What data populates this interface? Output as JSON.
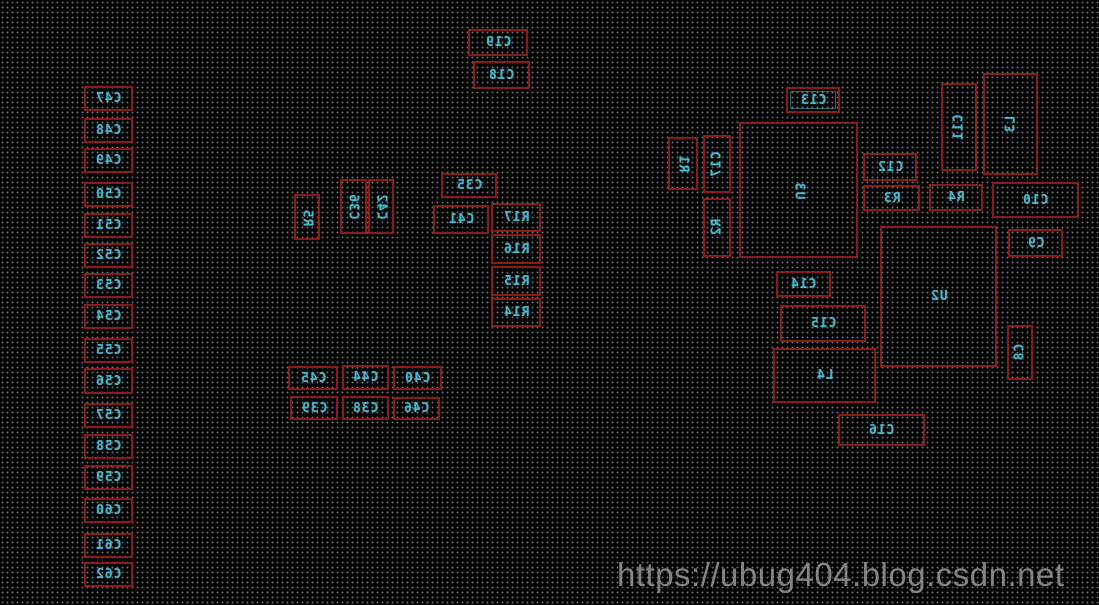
{
  "board": {
    "view": "pcb-bottom-layer-mirrored",
    "colors": {
      "background": "#000000",
      "grid_dots": "#cddce1",
      "component_outline": "#8a1b1b",
      "designator_text": "#46b8cc",
      "watermark_text": "#8f8f8f"
    },
    "components": [
      {
        "id": "C47",
        "label": "C47",
        "x": 84,
        "y": 86,
        "w": 49,
        "h": 25,
        "orient": "h"
      },
      {
        "id": "C48",
        "label": "C48",
        "x": 84,
        "y": 118,
        "w": 49,
        "h": 25,
        "orient": "h"
      },
      {
        "id": "C49",
        "label": "C49",
        "x": 84,
        "y": 148,
        "w": 49,
        "h": 25,
        "orient": "h"
      },
      {
        "id": "C50",
        "label": "C50",
        "x": 84,
        "y": 182,
        "w": 49,
        "h": 25,
        "orient": "h"
      },
      {
        "id": "C51",
        "label": "C51",
        "x": 84,
        "y": 213,
        "w": 49,
        "h": 25,
        "orient": "h"
      },
      {
        "id": "C52",
        "label": "C52",
        "x": 84,
        "y": 243,
        "w": 49,
        "h": 25,
        "orient": "h"
      },
      {
        "id": "C53",
        "label": "C53",
        "x": 84,
        "y": 273,
        "w": 49,
        "h": 25,
        "orient": "h"
      },
      {
        "id": "C54",
        "label": "C54",
        "x": 84,
        "y": 304,
        "w": 49,
        "h": 25,
        "orient": "h"
      },
      {
        "id": "C55",
        "label": "C55",
        "x": 84,
        "y": 338,
        "w": 49,
        "h": 25,
        "orient": "h"
      },
      {
        "id": "C56",
        "label": "C56",
        "x": 84,
        "y": 368,
        "w": 49,
        "h": 26,
        "orient": "h"
      },
      {
        "id": "C57",
        "label": "C57",
        "x": 84,
        "y": 403,
        "w": 49,
        "h": 25,
        "orient": "h"
      },
      {
        "id": "C58",
        "label": "C58",
        "x": 84,
        "y": 434,
        "w": 49,
        "h": 25,
        "orient": "h"
      },
      {
        "id": "C59",
        "label": "C59",
        "x": 84,
        "y": 465,
        "w": 49,
        "h": 25,
        "orient": "h"
      },
      {
        "id": "C60",
        "label": "C60",
        "x": 84,
        "y": 498,
        "w": 49,
        "h": 25,
        "orient": "h"
      },
      {
        "id": "C61",
        "label": "C61",
        "x": 84,
        "y": 533,
        "w": 49,
        "h": 25,
        "orient": "h"
      },
      {
        "id": "C62",
        "label": "C62",
        "x": 84,
        "y": 562,
        "w": 49,
        "h": 25,
        "orient": "h"
      },
      {
        "id": "C19",
        "label": "C19",
        "x": 468,
        "y": 29,
        "w": 60,
        "h": 27,
        "orient": "h"
      },
      {
        "id": "C18",
        "label": "C18",
        "x": 473,
        "y": 61,
        "w": 57,
        "h": 28,
        "orient": "h"
      },
      {
        "id": "R5",
        "label": "R5",
        "x": 294,
        "y": 194,
        "w": 26,
        "h": 46,
        "orient": "vu"
      },
      {
        "id": "C36",
        "label": "C36",
        "x": 340,
        "y": 179,
        "w": 27,
        "h": 55,
        "orient": "vu"
      },
      {
        "id": "C42",
        "label": "C42",
        "x": 368,
        "y": 179,
        "w": 26,
        "h": 55,
        "orient": "vu"
      },
      {
        "id": "C35",
        "label": "C35",
        "x": 441,
        "y": 173,
        "w": 56,
        "h": 25,
        "orient": "h"
      },
      {
        "id": "C41",
        "label": "C41",
        "x": 433,
        "y": 205,
        "w": 56,
        "h": 29,
        "orient": "h"
      },
      {
        "id": "R17",
        "label": "R17",
        "x": 491,
        "y": 203,
        "w": 50,
        "h": 29,
        "orient": "h"
      },
      {
        "id": "R16",
        "label": "R16",
        "x": 491,
        "y": 234,
        "w": 50,
        "h": 30,
        "orient": "h"
      },
      {
        "id": "R15",
        "label": "R15",
        "x": 491,
        "y": 266,
        "w": 50,
        "h": 30,
        "orient": "h"
      },
      {
        "id": "R14",
        "label": "R14",
        "x": 491,
        "y": 298,
        "w": 50,
        "h": 29,
        "orient": "h"
      },
      {
        "id": "C45",
        "label": "C45",
        "x": 288,
        "y": 366,
        "w": 50,
        "h": 24,
        "orient": "h"
      },
      {
        "id": "C44",
        "label": "C44",
        "x": 342,
        "y": 365,
        "w": 47,
        "h": 25,
        "orient": "h"
      },
      {
        "id": "C40",
        "label": "C40",
        "x": 393,
        "y": 366,
        "w": 49,
        "h": 24,
        "orient": "h"
      },
      {
        "id": "C39",
        "label": "C39",
        "x": 290,
        "y": 396,
        "w": 48,
        "h": 24,
        "orient": "h"
      },
      {
        "id": "C38",
        "label": "C38",
        "x": 342,
        "y": 396,
        "w": 47,
        "h": 24,
        "orient": "h"
      },
      {
        "id": "C46",
        "label": "C46",
        "x": 393,
        "y": 397,
        "w": 47,
        "h": 23,
        "orient": "h"
      },
      {
        "id": "C13",
        "label": "C13",
        "x": 786,
        "y": 87,
        "w": 54,
        "h": 26,
        "orient": "h",
        "inner": true
      },
      {
        "id": "R1",
        "label": "R1",
        "x": 668,
        "y": 137,
        "w": 30,
        "h": 53,
        "orient": "vu"
      },
      {
        "id": "C17",
        "label": "C17",
        "x": 703,
        "y": 135,
        "w": 28,
        "h": 58,
        "orient": "vd"
      },
      {
        "id": "R2",
        "label": "R2",
        "x": 703,
        "y": 198,
        "w": 28,
        "h": 59,
        "orient": "vd"
      },
      {
        "id": "U3",
        "label": "U3",
        "x": 739,
        "y": 122,
        "w": 119,
        "h": 136,
        "orient": "vu"
      },
      {
        "id": "C12",
        "label": "C12",
        "x": 863,
        "y": 153,
        "w": 54,
        "h": 28,
        "orient": "h"
      },
      {
        "id": "R3",
        "label": "R3",
        "x": 863,
        "y": 185,
        "w": 57,
        "h": 26,
        "orient": "h"
      },
      {
        "id": "R4",
        "label": "R4",
        "x": 929,
        "y": 184,
        "w": 54,
        "h": 27,
        "orient": "h"
      },
      {
        "id": "C10",
        "label": "C10",
        "x": 992,
        "y": 182,
        "w": 87,
        "h": 36,
        "orient": "h"
      },
      {
        "id": "C11",
        "label": "C11",
        "x": 941,
        "y": 83,
        "w": 36,
        "h": 88,
        "orient": "vd"
      },
      {
        "id": "L3",
        "label": "L3",
        "x": 983,
        "y": 73,
        "w": 55,
        "h": 102,
        "orient": "vd"
      },
      {
        "id": "C9",
        "label": "C9",
        "x": 1008,
        "y": 229,
        "w": 55,
        "h": 28,
        "orient": "h"
      },
      {
        "id": "U2",
        "label": "U2",
        "x": 880,
        "y": 226,
        "w": 117,
        "h": 141,
        "orient": "h"
      },
      {
        "id": "C8",
        "label": "C8",
        "x": 1007,
        "y": 325,
        "w": 26,
        "h": 55,
        "orient": "vd"
      },
      {
        "id": "C14",
        "label": "C14",
        "x": 776,
        "y": 271,
        "w": 55,
        "h": 26,
        "orient": "h"
      },
      {
        "id": "C15",
        "label": "C15",
        "x": 780,
        "y": 305,
        "w": 86,
        "h": 37,
        "orient": "h"
      },
      {
        "id": "L4",
        "label": "L4",
        "x": 773,
        "y": 348,
        "w": 103,
        "h": 55,
        "orient": "h"
      },
      {
        "id": "C16",
        "label": "C16",
        "x": 838,
        "y": 414,
        "w": 87,
        "h": 32,
        "orient": "h"
      }
    ]
  },
  "watermark": {
    "text": "https://ubug404.blog.csdn.net",
    "x": 617,
    "y": 556
  }
}
